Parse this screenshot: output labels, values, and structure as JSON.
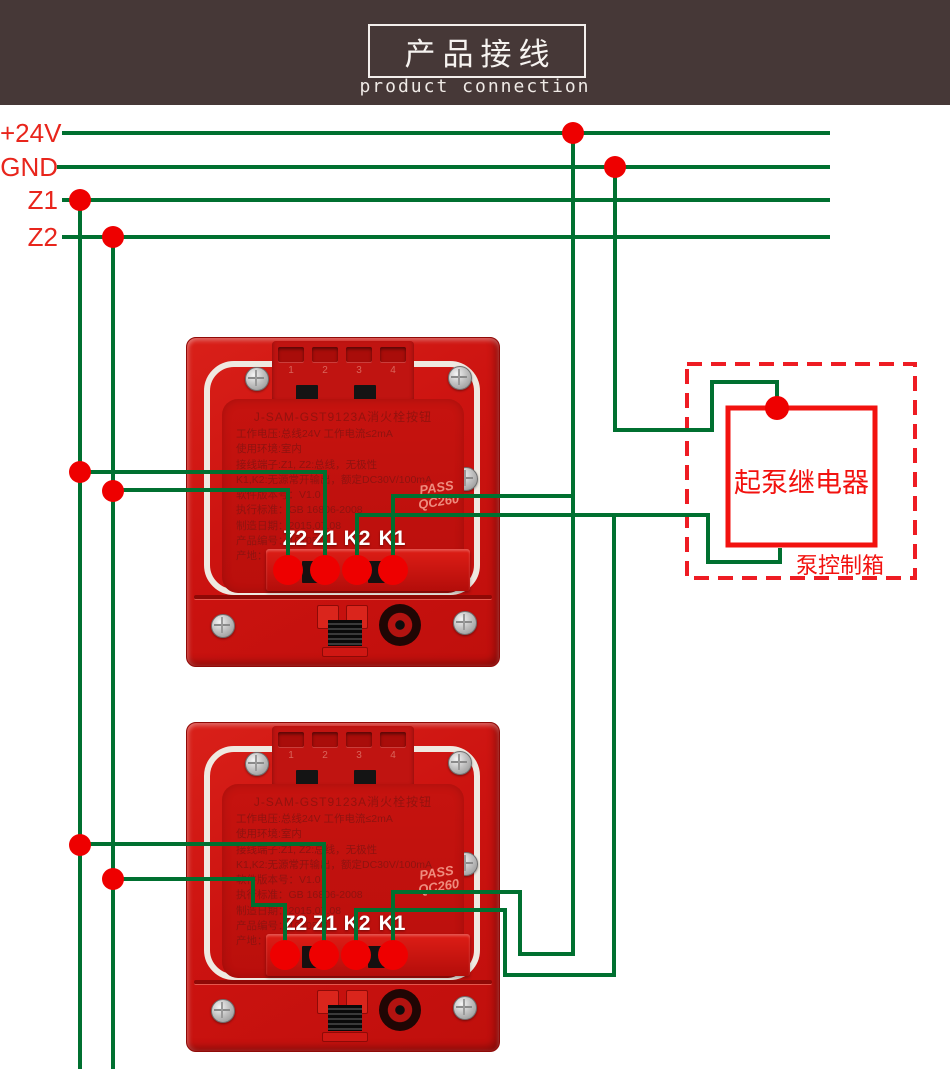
{
  "header": {
    "title": "产品接线",
    "subtitle": "product connection"
  },
  "bus": {
    "labels": [
      "+24V",
      "GND",
      "Z1",
      "Z2"
    ]
  },
  "relay": {
    "label": "起泵继电器",
    "box_label": "泵控制箱"
  },
  "device": {
    "model": "J-SAM-GST9123A消火栓按钮",
    "specs": [
      "工作电压:总线24V 工作电流≤2mA",
      "使用环境:室内",
      "接线端子:Z1, Z2:总线，无极性",
      "K1,K2:无源常开输出，额定DC30V/100mA",
      "软件版本号：V1.0",
      "执行标准：GB 16806-2008",
      "制造日期：2015.07.08",
      "产品编号：10105211",
      "产地：河北省秦皇岛开发区长江东道80号"
    ],
    "company": "海湾安全技术有限公司",
    "stamp_line1": "PASS",
    "stamp_line2": "QC260",
    "clips": [
      "1",
      "2",
      "3",
      "4"
    ],
    "terminals": [
      "Z2",
      "Z1",
      "K2",
      "K1"
    ]
  },
  "colors": {
    "wire_green": "#007030",
    "dot_red": "#ee0000",
    "label_red": "#e8251c",
    "relay_red": "#f2120f",
    "header_bg": "#463837",
    "device_red": "#cc1310"
  }
}
